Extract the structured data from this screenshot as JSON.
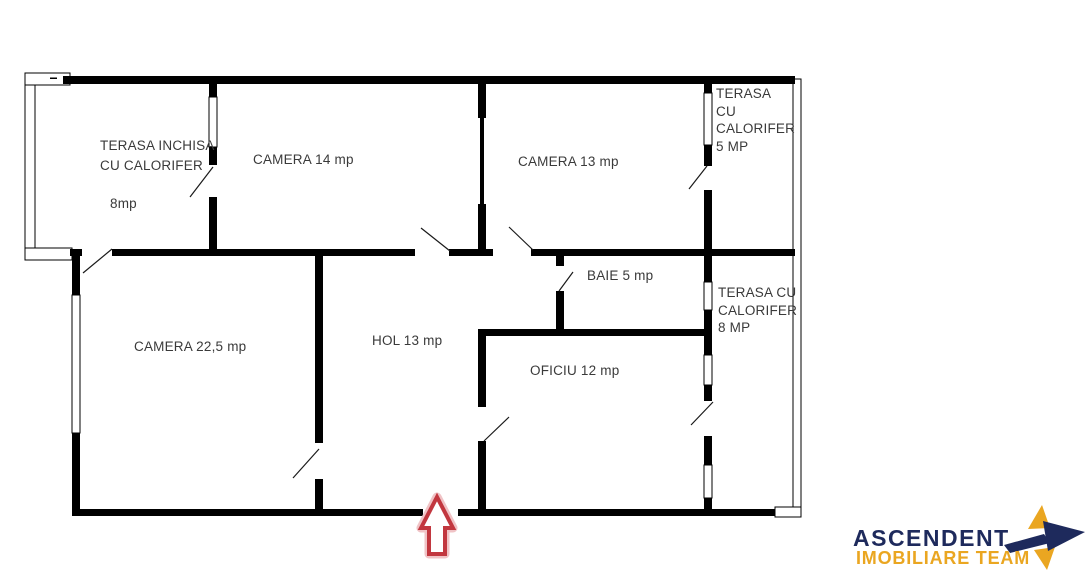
{
  "floorplan": {
    "rooms": {
      "terasa_inchisa": {
        "line1": "TERASA INCHISA",
        "line2": "CU CALORIFER",
        "area": "8mp"
      },
      "camera_14": {
        "label": "CAMERA 14 mp"
      },
      "camera_13": {
        "label": "CAMERA 13 mp"
      },
      "terasa_5": {
        "line1": "TERASA",
        "line2": "CU",
        "line3": "CALORIFER",
        "line4": "5 MP"
      },
      "camera_22_5": {
        "label": "CAMERA 22,5 mp"
      },
      "hol": {
        "label": "HOL 13 mp"
      },
      "baie": {
        "label": "BAIE 5 mp"
      },
      "oficiu": {
        "label": "OFICIU 12 mp"
      },
      "terasa_8": {
        "line1": "TERASA CU",
        "line2": "CALORIFER",
        "line3": "8 MP"
      }
    },
    "colors": {
      "wall": "#000000",
      "entrance_arrow": "#C2373F"
    }
  },
  "branding": {
    "name": "ASCENDENT",
    "tagline": "IMOBILIARE TEAM",
    "name_color": "#1E2A5C",
    "tagline_color": "#EAA621",
    "star_navy": "#1E2A5C",
    "star_gold": "#EAA621"
  }
}
